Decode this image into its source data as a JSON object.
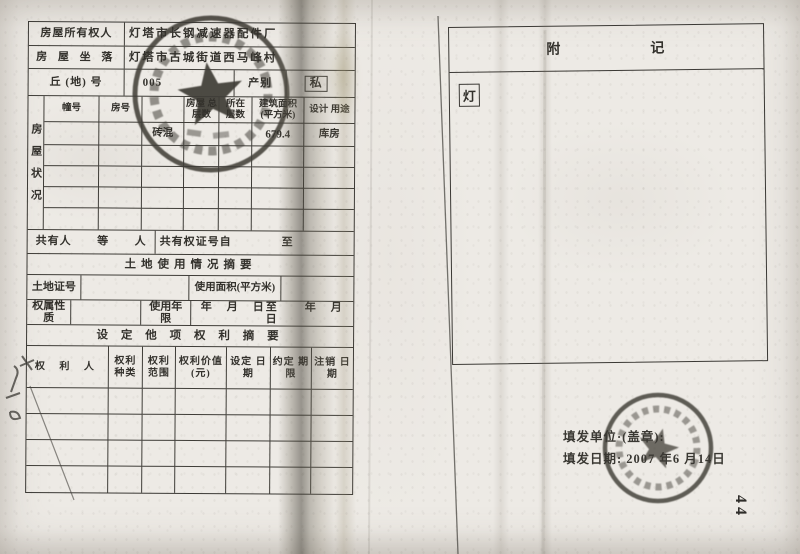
{
  "form": {
    "owner_label": "房屋所有权人",
    "owner_value": "灯塔市长钢减速器配件厂",
    "location_label": "房 屋 坐 落",
    "location_value": "灯塔市古城街道西马峰村",
    "lot_label": "丘 (地) 号",
    "lot_value": "005",
    "category_label": "产别",
    "category_value": "私",
    "condition": {
      "side_label": "房屋状况",
      "headers": [
        "幢号",
        "房号",
        "",
        "房屋 总层数",
        "所在 层数",
        "建筑面积 (平方米)",
        "设计 用途"
      ],
      "data_row": [
        "",
        "",
        "砖混",
        "",
        "",
        "679.4",
        "库房"
      ]
    },
    "co_owner_label": "共有人",
    "co_owner_mid": "等",
    "co_owner_unit": "人",
    "co_cert_label": "共有权证号自",
    "co_cert_to": "至",
    "land_section_title": "土地使用情况摘要",
    "land_cert_label": "土地证号",
    "land_area_label": "使用面积(平方米)",
    "tenure_label": "权属性质",
    "use_term_label": "使用年限",
    "use_term_dates": "年　月　日至　　年　月　日",
    "rights_section_title": "设 定 他 项 权 利 摘 要",
    "rights_headers": [
      "权 利 人",
      "权利 种类",
      "权利 范围",
      "权利价值 (元)",
      "设定 日期",
      "约定 期限",
      "注销 日期"
    ]
  },
  "appendix": {
    "title_left": "附",
    "title_right": "记",
    "boxed_char": "灯"
  },
  "footer": {
    "issuer_label": "填发单位·(盖章):",
    "date_label": "填发日期:",
    "date_value": "2007 年6 月14日"
  },
  "annotations": {
    "page_number": "44"
  },
  "colors": {
    "paper": "#edeae5",
    "ink": "#33312c",
    "stamp_ink": "#3a3831"
  }
}
